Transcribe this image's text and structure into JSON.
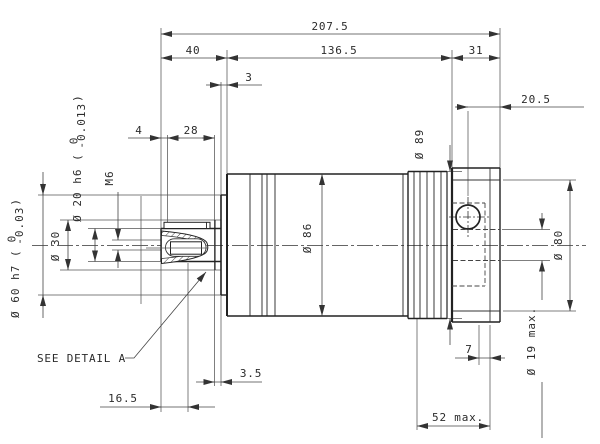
{
  "drawing": {
    "colors": {
      "background": "#ffffff",
      "line": "#222222",
      "thin_line": "#555555"
    },
    "note_detail": "SEE DETAIL A",
    "dims": {
      "total_length": "207.5",
      "shaft_section": "40",
      "housing_section": "136.5",
      "adapter_section": "31",
      "pilot_step": "3",
      "screw_offset": "20.5",
      "key_start": "4",
      "key_length": "28",
      "collar_step": "3.5",
      "keyway_pos": "16.5",
      "slot_depth": "7",
      "clamp_depth": "52 max.",
      "thread": "M6",
      "collar_dia": "Ø 30",
      "housing_dia": "Ø 86",
      "ring_dia": "Ø 89",
      "flange_dia": "Ø 80",
      "bore_dia": "Ø 19 max.",
      "shaft_dia": {
        "prefix": "Ø 20 h6 (",
        "tol_top": "0",
        "tol_bottom": "-0.013",
        "suffix": ")"
      },
      "pilot_dia": {
        "prefix": "Ø 60 h7 (",
        "tol_top": "0",
        "tol_bottom": "-0.03",
        "suffix": ")"
      }
    }
  }
}
